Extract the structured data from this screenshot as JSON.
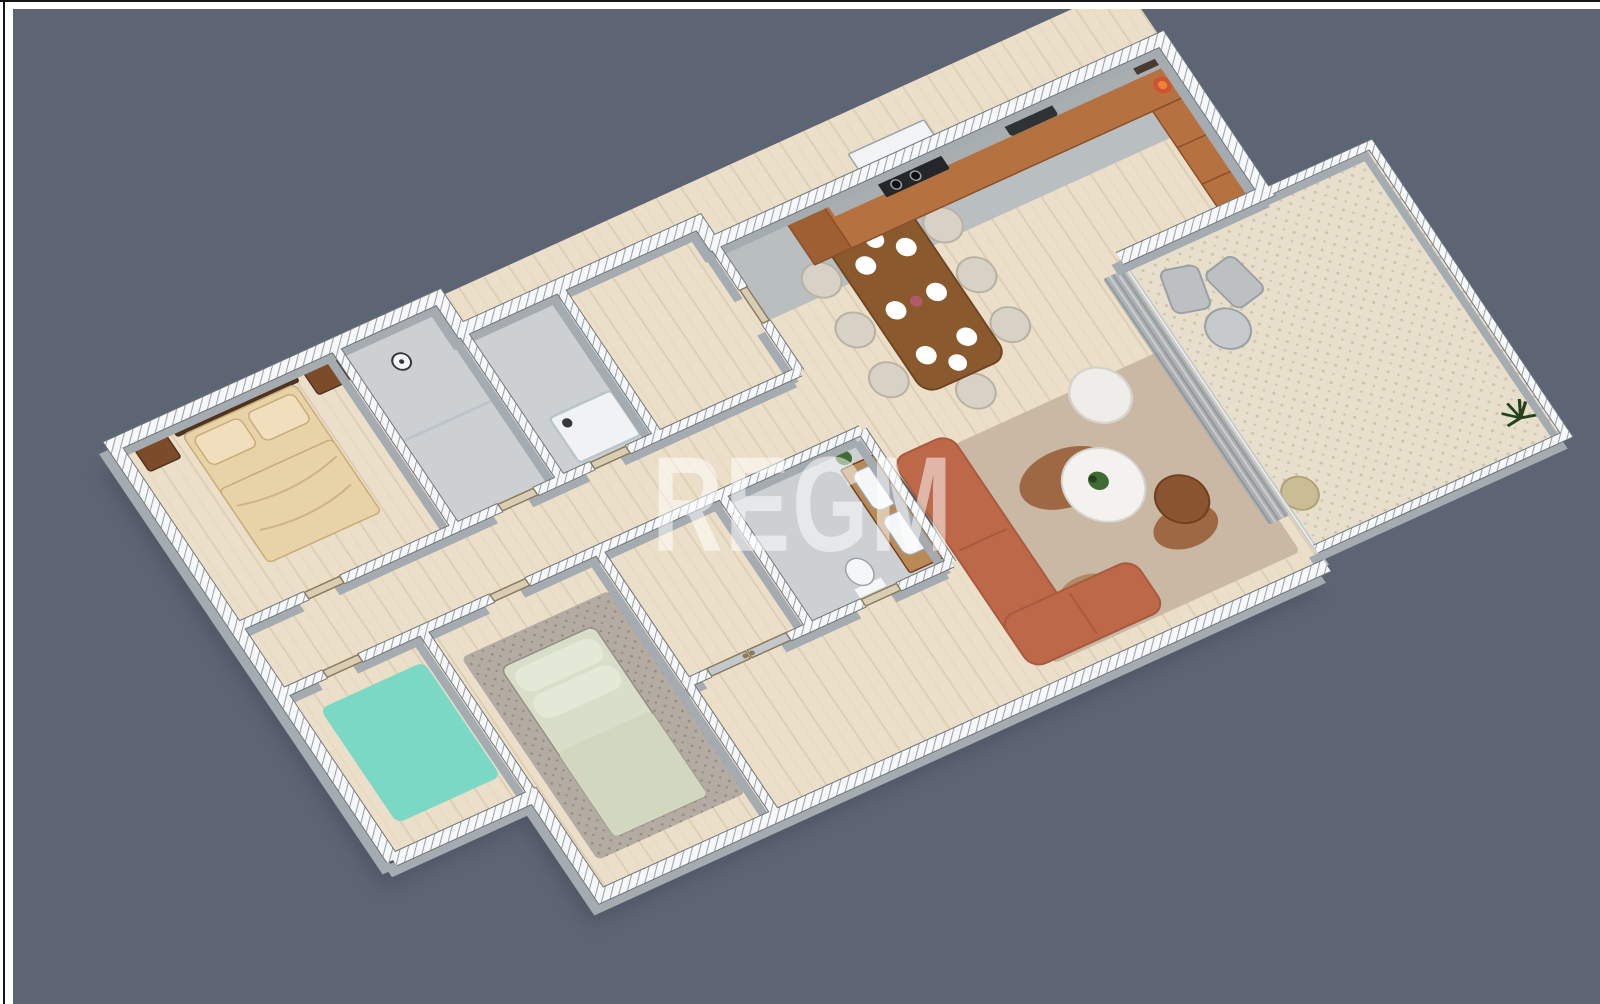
{
  "watermark": {
    "text": "REGM"
  },
  "canvas": {
    "background": "#5d6473",
    "page_background": "#ffffff",
    "frame_color": "#141414"
  },
  "palette": {
    "shadow": "#3c4454",
    "wall_top": "#f7f8f9",
    "wall_hatch_line": "#9aa2aa",
    "wall_face": "#a4abb1",
    "wall_edge": "#6e747a",
    "floor_wood": "#ecdfc9",
    "floor_plank_line": "#ddcfb4",
    "floor_tile": "#ccd0d3",
    "kitchen_floor": "#b9bec1",
    "gravel": "#e7dfcc",
    "gravel_dot": "#cfc4a9",
    "glass": "#b8c4c8",
    "curtain": "#a7adb2",
    "curtain_light": "#c9ced2",
    "curtain_dark": "#878d92",
    "door": "#d9cdb4",
    "door_edge": "#8a7a5c",
    "closet_door": "#c3c8cc",
    "cabinet": "#b5713f",
    "cabinet_dark": "#a05f33",
    "cabinet_edge": "#8a4f28",
    "counter": "#a9aeb1",
    "hood": "#f2f3f4",
    "appliance": "#23272a",
    "burner": "#0e0f10",
    "sink": "#2e3336",
    "shelf_dark": "#4a3a30",
    "bowl": "#cf5330",
    "bowl_inner": "#e8833c",
    "dining_table": "#8a5a2e",
    "dining_table_edge": "#6f4521",
    "chair": "#d8d1c5",
    "chair_edge": "#b9b1a3",
    "plate": "#ffffff",
    "centerpiece": "#b05a6a",
    "sofa": "#bc6849",
    "sofa_edge": "#a85a3e",
    "armchair": "#efede9",
    "armchair_edge": "#d7d3cc",
    "coffee_table": "#f4f2ee",
    "coffee_table_edge": "#d8d5cf",
    "side_table": "#8a5530",
    "side_table_edge": "#6f3f1f",
    "rug_living": "#c9b8a4",
    "rug_patch": "#9d6843",
    "rug_patch_light": "#b08a62",
    "rug_teal": "#7bd8c4",
    "rug_gray": "#b4aca3",
    "rug_gray_dot": "#958c83",
    "bed_beige": "#e8d2a8",
    "bed_pillow": "#f0debc",
    "bed_fold": "#c8ab79",
    "headboard": "#4e3320",
    "nightstand": "#7c4b2a",
    "bed_sage": "#d9decb",
    "bed_sage_light": "#e4e8d6",
    "bed_sage_duvet": "#d2d8c0",
    "picture_frame": "#3a3d40",
    "fixture_white": "#f5f6f7",
    "fixture_edge": "#9aa2a8",
    "vanity_wood": "#b98a55",
    "mirror": "#33383b",
    "plant": "#3f6b35",
    "plant_dark": "#24411e",
    "terrace_chair": "#bcc0c3",
    "terrace_chair_edge": "#9aa0a4",
    "terrace_table": "#c6cacd",
    "pouf": "#cabd94",
    "pouf_edge": "#b0a274"
  }
}
